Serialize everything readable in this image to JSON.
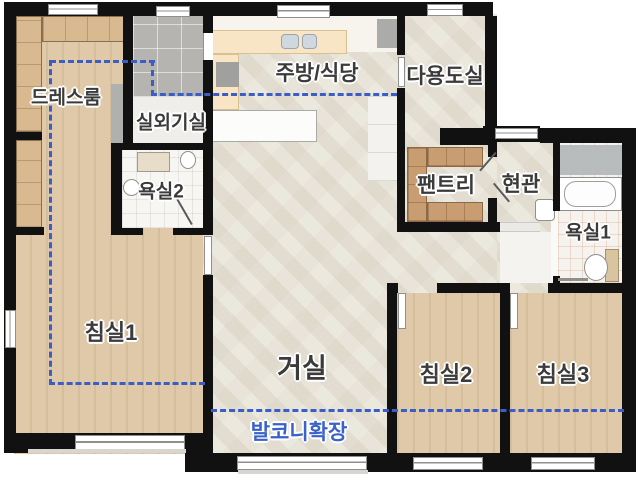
{
  "rooms": [
    {
      "id": "dressroom",
      "label": "드레스룸"
    },
    {
      "id": "outdoor-unit",
      "label": "실외기실"
    },
    {
      "id": "bathroom2",
      "label": "욕실2"
    },
    {
      "id": "kitchen",
      "label": "주방/식당"
    },
    {
      "id": "utility",
      "label": "다용도실"
    },
    {
      "id": "pantry",
      "label": "팬트리"
    },
    {
      "id": "entrance",
      "label": "현관"
    },
    {
      "id": "bathroom1",
      "label": "욕실1"
    },
    {
      "id": "bedroom1",
      "label": "침실1"
    },
    {
      "id": "living",
      "label": "거실"
    },
    {
      "id": "bedroom2",
      "label": "침실2"
    },
    {
      "id": "bedroom3",
      "label": "침실3"
    }
  ],
  "annotations": {
    "balcony_extension": "발코니확장"
  },
  "colors": {
    "wall": "#111111",
    "balcony_line": "#3a5ec6",
    "balcony_text": "#3a62c8",
    "wood_floor": "#dfc9a8",
    "marble_floor": "#e9e5da",
    "gray_tile": "#b6b4b1",
    "white_tile": "#f7f6f2",
    "counter": "#f8e5c6",
    "shelf": "#c89d72",
    "label_text": "#3b3b3b"
  }
}
